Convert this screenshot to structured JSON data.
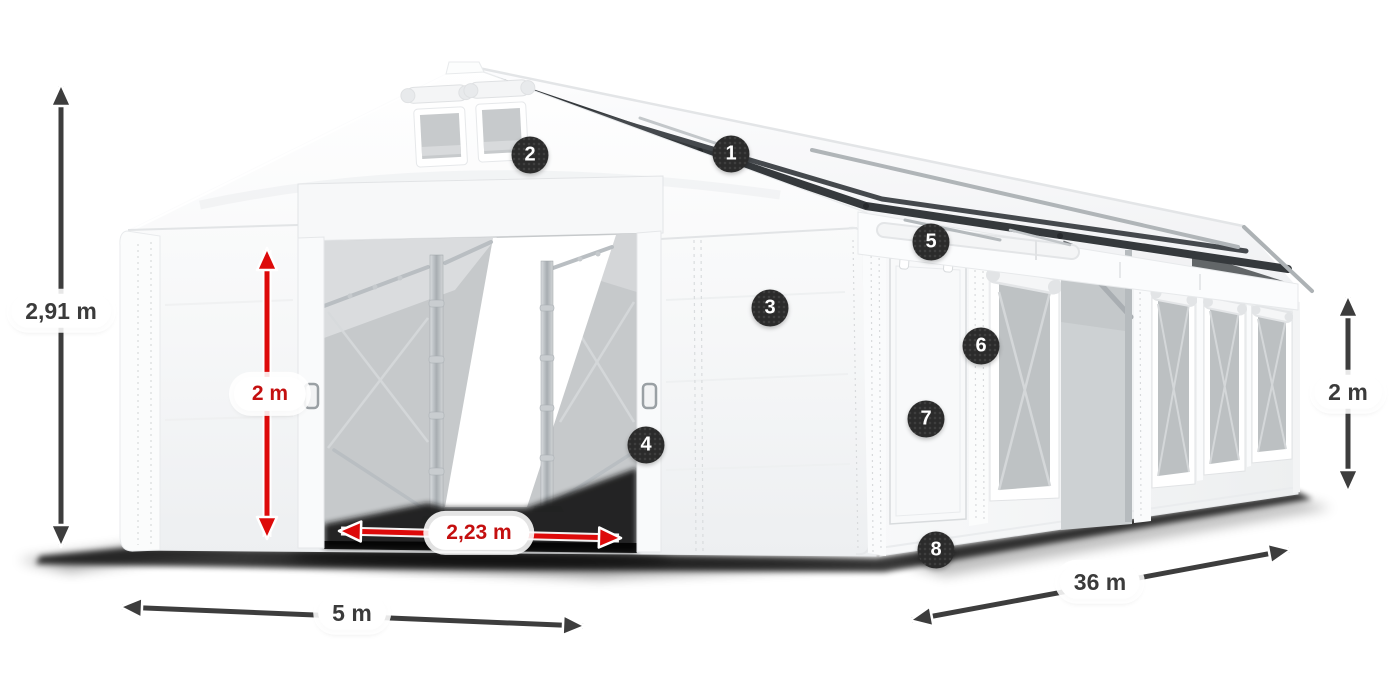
{
  "dimension_labels": {
    "ridge_height": "2,91 m",
    "entrance_height": "2 m",
    "entrance_width": "2,23 m",
    "tent_width": "5 m",
    "tent_length": "36 m",
    "side_wall_height": "2 m"
  },
  "callouts": [
    {
      "number": "1"
    },
    {
      "number": "2"
    },
    {
      "number": "3"
    },
    {
      "number": "4"
    },
    {
      "number": "5"
    },
    {
      "number": "6"
    },
    {
      "number": "7"
    },
    {
      "number": "8"
    }
  ],
  "colors": {
    "background": "#ffffff",
    "dimension_arrow_red": "#dd0a0a",
    "dimension_arrow_gray": "#3d3d3d",
    "dimension_text_red": "#c40f0f",
    "dimension_text_gray": "#3b3b3b",
    "callout_badge_background": "#2b2b2b",
    "callout_badge_text": "#ffffff",
    "roof_rail_dark": "#35393c",
    "tent_white": "#f7f8f9",
    "mesh_gray": "#c6c9cb"
  }
}
